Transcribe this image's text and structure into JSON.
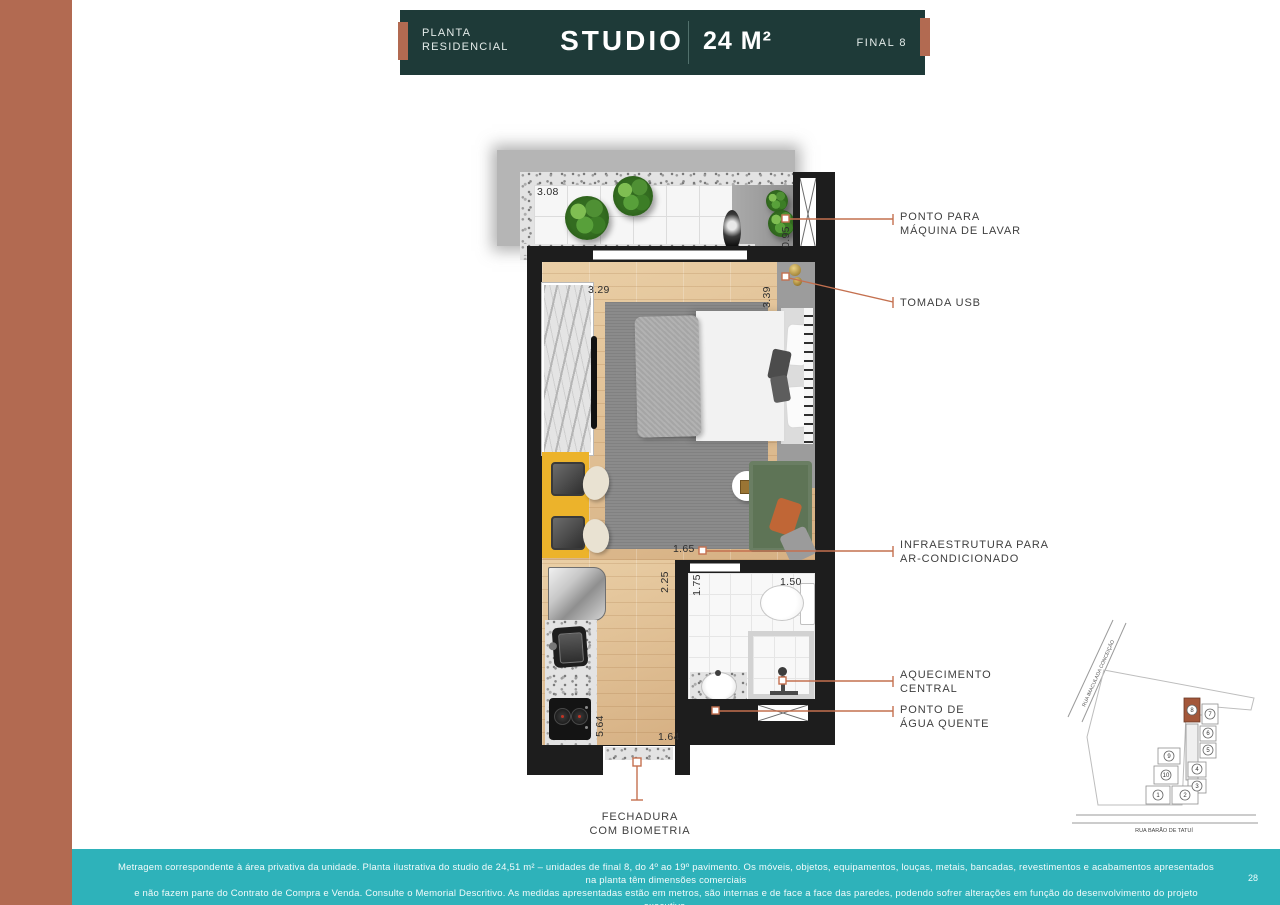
{
  "header": {
    "eyebrow": "PLANTA RESIDENCIAL",
    "title": "STUDIO",
    "area": "24 M²",
    "final": "FINAL 8"
  },
  "plan": {
    "dimensions": [
      {
        "id": "balcony-width",
        "value": "3.08"
      },
      {
        "id": "laundry-depth",
        "value": "0.95"
      },
      {
        "id": "bedroom-width",
        "value": "3.29"
      },
      {
        "id": "bedroom-depth",
        "value": "3.39"
      },
      {
        "id": "ac-span",
        "value": "1.65"
      },
      {
        "id": "hall-depth",
        "value": "2.25"
      },
      {
        "id": "bath-depth",
        "value": "1.75"
      },
      {
        "id": "bath-width",
        "value": "1.50"
      },
      {
        "id": "kitchen-depth",
        "value": "5.64"
      },
      {
        "id": "entry-width",
        "value": "1.64"
      }
    ],
    "callouts": [
      {
        "id": "washing-machine",
        "lines": [
          "PONTO PARA",
          "MÁQUINA DE LAVAR"
        ]
      },
      {
        "id": "usb-outlet",
        "lines": [
          "TOMADA USB",
          ""
        ]
      },
      {
        "id": "ac-infra",
        "lines": [
          "INFRAESTRUTURA PARA",
          "AR-CONDICIONADO"
        ]
      },
      {
        "id": "central-heating",
        "lines": [
          "AQUECIMENTO",
          "CENTRAL"
        ]
      },
      {
        "id": "hot-water",
        "lines": [
          "PONTO DE",
          "ÁGUA QUENTE"
        ]
      },
      {
        "id": "biometric-lock",
        "lines": [
          "FECHADURA",
          "COM BIOMETRIA"
        ]
      }
    ]
  },
  "minimap": {
    "street_left": "RUA IMACULADA CONCEIÇÃO",
    "street_bottom": "RUA BARÃO DE TATUÍ",
    "highlighted_unit": "8",
    "units": [
      "1",
      "2",
      "3",
      "4",
      "5",
      "6",
      "7",
      "8",
      "9",
      "10"
    ]
  },
  "footer": {
    "line1": "Metragem correspondente à área privativa da unidade. Planta ilustrativa do studio de 24,51 m² – unidades de final 8, do 4º ao 19º pavimento. Os móveis, objetos, equipamentos, louças, metais, bancadas, revestimentos e acabamentos apresentados na planta têm dimensões comerciais",
    "line2": "e não fazem parte do Contrato de Compra e Venda. Consulte o Memorial Descritivo. As medidas apresentadas estão em metros, são internas e de face a face das paredes, podendo sofrer alterações em função do desenvolvimento do projeto executivo.",
    "page": "28"
  },
  "colors": {
    "terracotta": "#b26a51",
    "header_teal": "#1e3a38",
    "footer_teal": "#2eb2ba",
    "leader": "#c4704f",
    "highlight_unit": "#a3573a"
  }
}
